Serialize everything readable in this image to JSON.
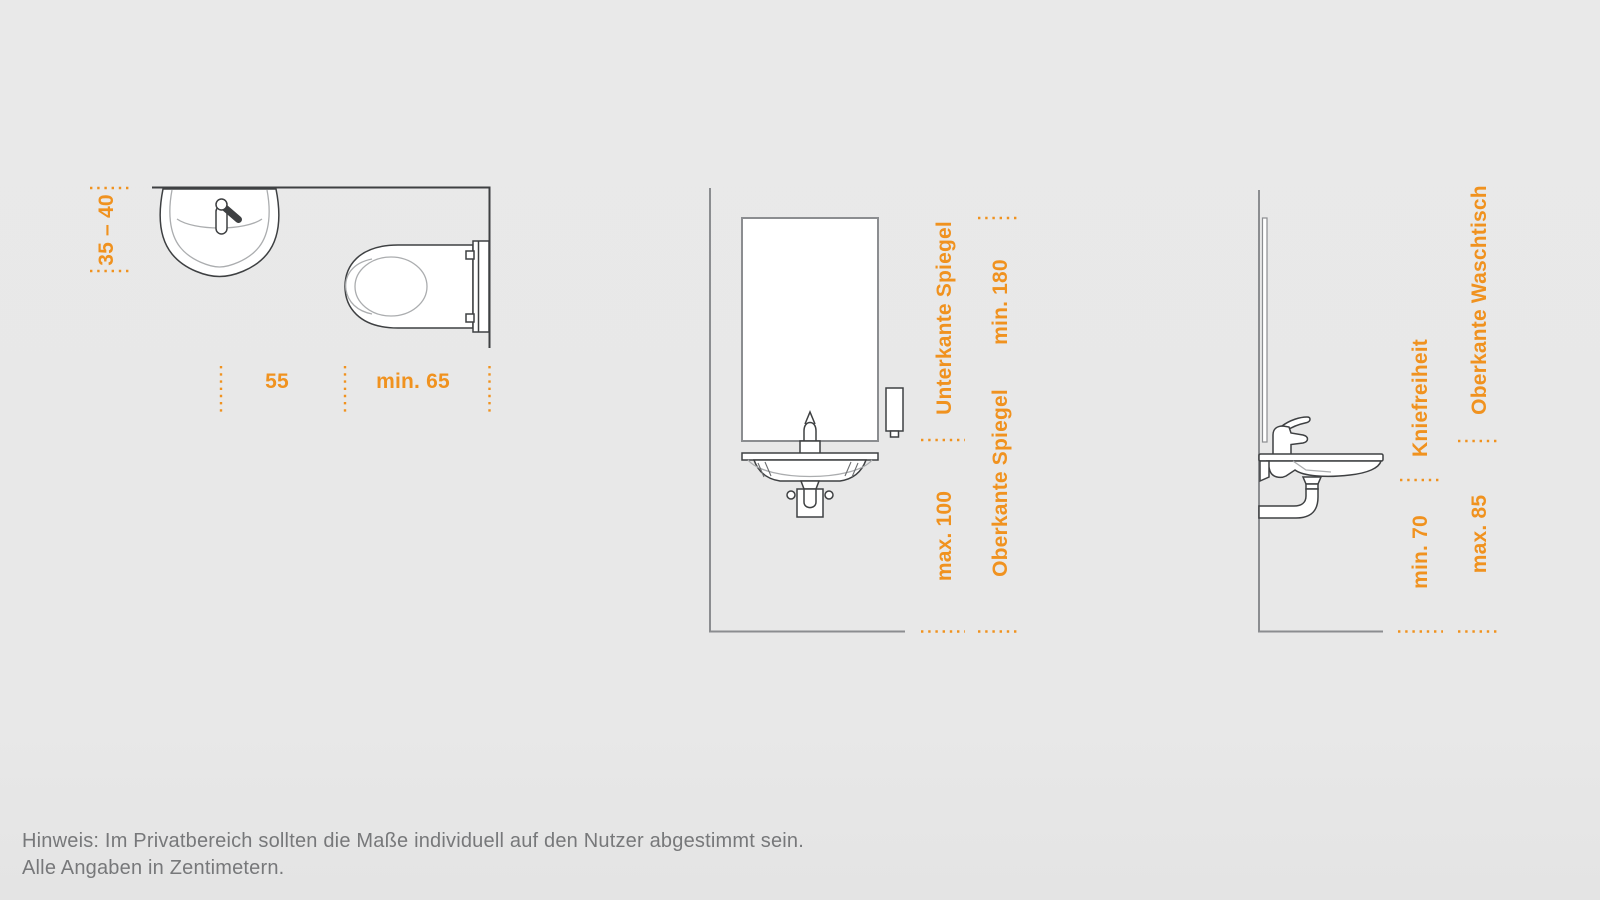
{
  "colors": {
    "accent": "#f0921f",
    "fixture_line": "#3e4042",
    "wall_line": "#8b8d90",
    "inner_line": "#abadaf",
    "background": "#e8e8e8",
    "note_text": "#77787a"
  },
  "plan_view": {
    "dim_wall_depth": "35 – 40",
    "dim_basin_spacing": "55",
    "dim_wc_zone": "min. 65"
  },
  "front_view": {
    "label_mirror_bottom": "Unterkante Spiegel",
    "dim_mirror_bottom": "max. 100",
    "dim_mirror_top": "min. 180",
    "label_mirror_top": "Oberkante Spiegel"
  },
  "side_view": {
    "label_knee_clearance": "Kniefreiheit",
    "dim_knee_clearance": "min. 70",
    "label_basin_top": "Oberkante Waschtisch",
    "dim_basin_top": "max. 85"
  },
  "note": {
    "line1": "Hinweis: Im Privatbereich sollten die Maße individuell auf den Nutzer abgestimmt sein.",
    "line2": "Alle Angaben in Zentimetern."
  }
}
